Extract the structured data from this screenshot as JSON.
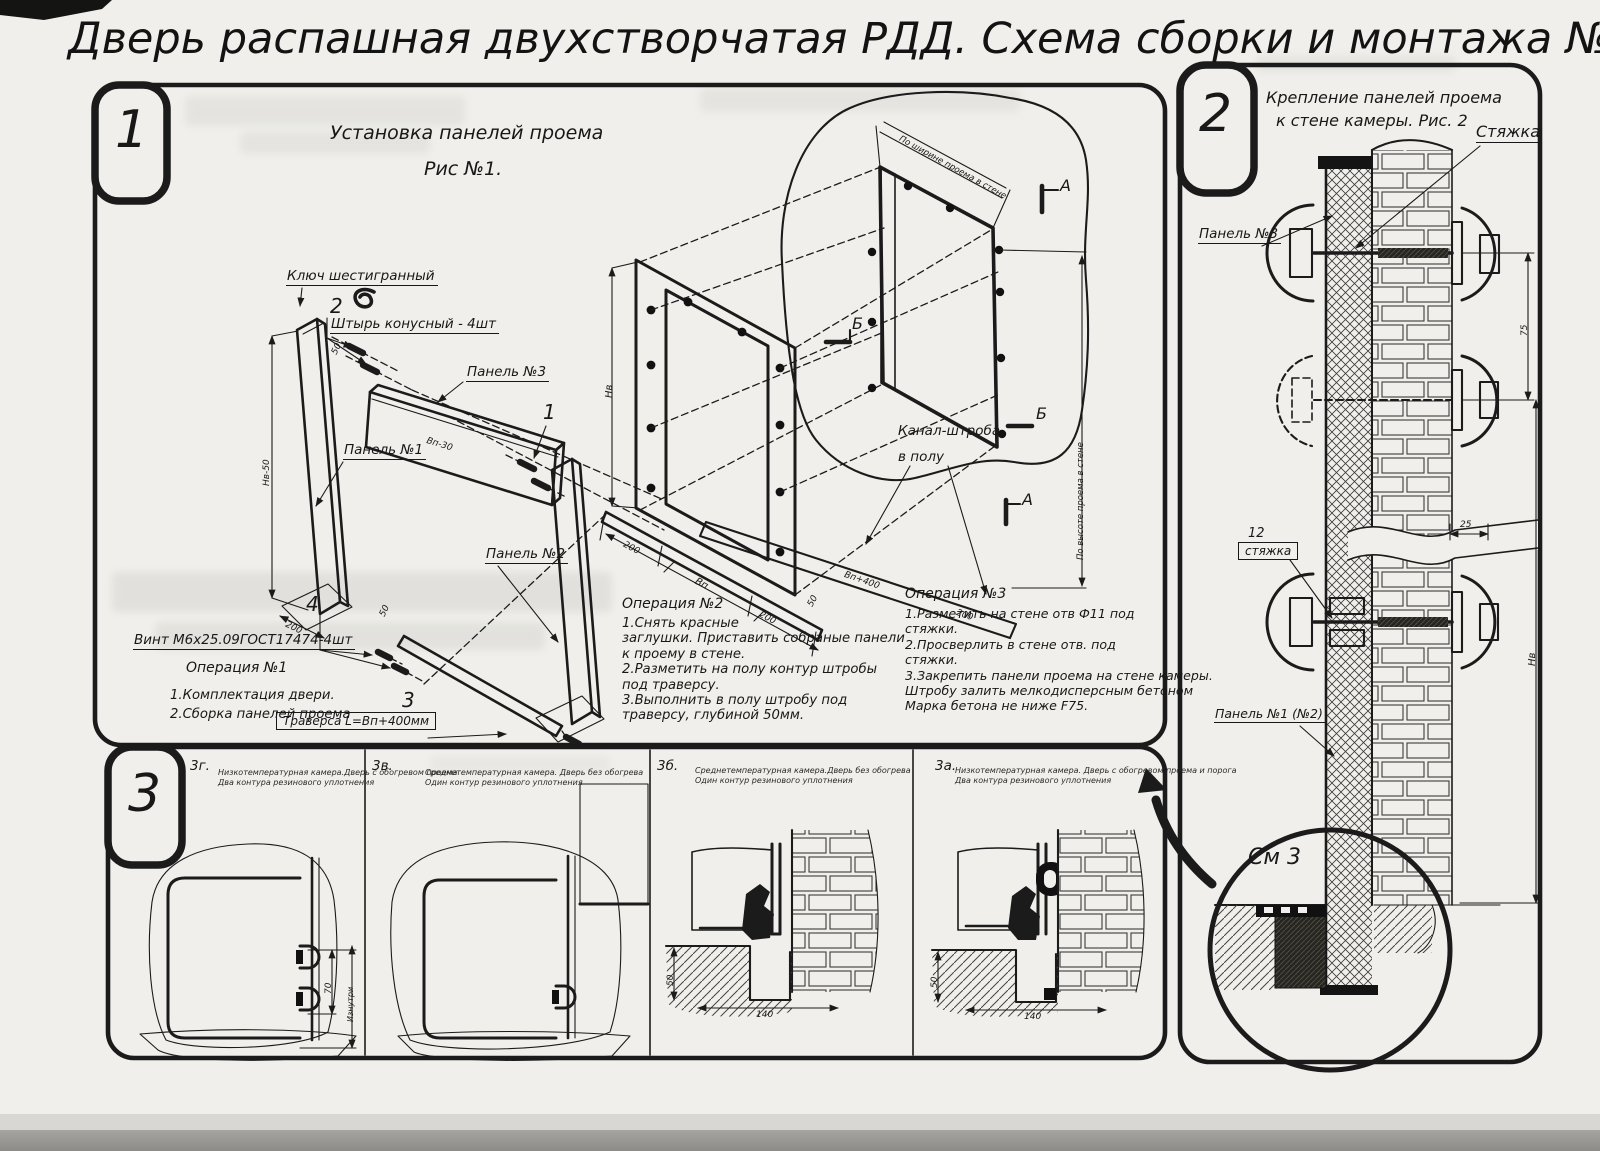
{
  "title": "Дверь распашная двухстворчатая РДД.  Схема сборки и монтажа №2",
  "s1": {
    "tag": "1",
    "heading1": "Установка панелей проема",
    "heading2": "Рис №1.",
    "lbl": {
      "hexkey": "Ключ шестигранный",
      "pin_no": "2",
      "pin": "Штырь конусный - 4шт",
      "panel3": "Панель №3",
      "no1": "1",
      "panel1": "Панель №1",
      "panel2": "Панель №2",
      "no4": "4",
      "screw": "Винт М6х25.09ГОСТ17474-4шт",
      "no3": "3",
      "traverse": "Траверса  L=Вп+400мм",
      "canal": "Канал-штроба\nв полу",
      "a": "А",
      "b": "Б"
    },
    "dim": {
      "hv50": "Нв-50",
      "d200": "200",
      "d50": "50",
      "bp30": "Вп-30",
      "hv": "Нв",
      "bp": "Вп",
      "bp400": "Вп+400",
      "w_note": "По ширине проема в стене",
      "h_note": "По высоте проема в стене"
    },
    "op1_title": "Операция №1",
    "op1_body": "1.Комплектация двери.\n2.Сборка панелей проема",
    "op2_title": "Операция №2",
    "op2_body": "1.Снять красные\nзаглушки. Приставить собраные панели\nк проему в стене.\n2.Разметить на полу контур штробы\nпод траверсу.\n3.Выполнить в полу штробу под\nтраверсу, глубиной 50мм.",
    "op3_title": "Операция №3",
    "op3_body": "1.Разметить на стене отв Ф11 под\nстяжки.\n2.Просверлить в стене отв.  под\nстяжки.\n3.Закрепить панели проема на стене камеры.\nШтробу залить мелкодисперсным бетоном\nМарка бетона не ниже  F75."
  },
  "s2": {
    "tag": "2",
    "heading1": "Крепление панелей проема",
    "heading2": "к стене камеры. Рис. 2",
    "lbl": {
      "tie": "Стяжка",
      "panel3": "Панель №3",
      "no12": "12",
      "tie12": "стяжка",
      "panel12": "Панель №1 (№2)",
      "see3": "См 3"
    },
    "dim": {
      "d75": "75",
      "d25": "25",
      "hv": "Нв"
    }
  },
  "s3": {
    "tag": "3",
    "panels": [
      {
        "id": "3г.",
        "note": "Низкотемпературная камера.Дверь с обогревом проема\nДва контура резинового уплотнения"
      },
      {
        "id": "3в.",
        "note": "Среднетемпературная камера. Дверь без обогрева\nОдин контур резинового уплотнения"
      },
      {
        "id": "3б.",
        "note": "Среднетемпературная камера.Дверь без обогрева\nОдин контур резинового уплотнения"
      },
      {
        "id": "3а.",
        "note": "Низкотемпературная камера. Дверь с обогревом проема и порога\nДва контура резинового уплотнения"
      }
    ],
    "dim": {
      "d70": "70",
      "inside": "Изнутри",
      "d50": "50",
      "d140": "140"
    }
  }
}
